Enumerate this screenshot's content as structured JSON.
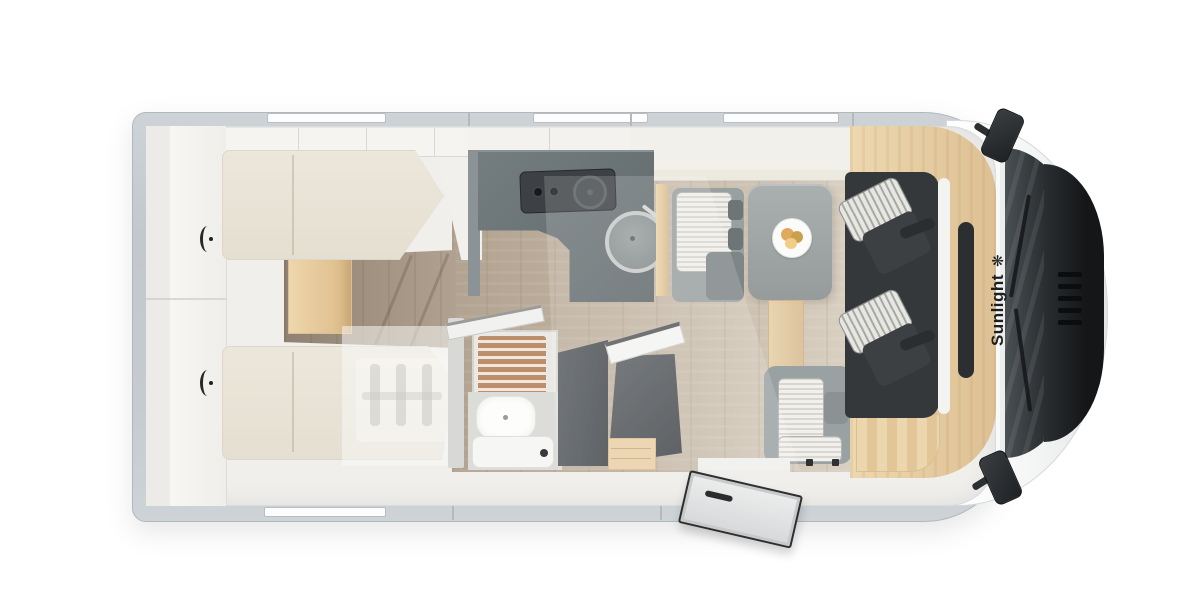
{
  "brand": {
    "name": "Sunlight",
    "logo_glyph": "❋"
  },
  "scene": {
    "type": "motorhome floor plan, top-down view",
    "front_direction": "right",
    "entry_door_state": "open, swung outside the bottom wall near the cab"
  },
  "rooms": [
    {
      "name": "rear-bedroom",
      "features": [
        "twin single beds",
        "wardrobe lockers along rear wall",
        "wood step between beds"
      ]
    },
    {
      "name": "kitchen",
      "features": [
        "L-shaped dark counter",
        "two-knob hob with burner",
        "round sink with faucet",
        "overhead lockers"
      ]
    },
    {
      "name": "bathroom",
      "features": [
        "shower with wood slat grate",
        "washbasin",
        "cassette toilet",
        "dark tall wardrobe",
        "open dark door panel",
        "wood drawer chest"
      ]
    },
    {
      "name": "dinette",
      "features": [
        "striped bench seat with headrests",
        "pedestal table",
        "plate with croissants",
        "second striped bench at entry"
      ]
    },
    {
      "name": "cab",
      "features": [
        "two swivel captain seats with striped inserts",
        "dark seat platform",
        "wood trim band",
        "windshield",
        "dark hood with grille",
        "two side mirrors",
        "wipers"
      ]
    }
  ],
  "windows": {
    "top_wall": 3,
    "bottom_wall": 1
  },
  "colors": {
    "wall": "#c6cbcf",
    "wall_edge": "#b2b7bb",
    "interior": "#f0efec",
    "wood_floor_dark": "#8f8171",
    "wood_floor_light": "#dbd2c4",
    "wood_accent": "#e9d0a6",
    "mattress": "#eae5d8",
    "counter": "#6d7578",
    "hob": "#3d4145",
    "dark_panel": "#4a4f53",
    "table": "#9ca2a2",
    "bench": "#99a0a0",
    "cushion_stripe_light": "#f0efeb",
    "cushion_stripe_dark": "#d6d4cf",
    "seat_platform": "#34383b",
    "seat_dark": "#3c4043",
    "cab_body": "#fafbfb",
    "windshield": "#26292c",
    "hood": "#17191b",
    "shower_slat": "#bc8e6d",
    "food": "#e0aa5e",
    "brand_text": "#1d1f21"
  }
}
